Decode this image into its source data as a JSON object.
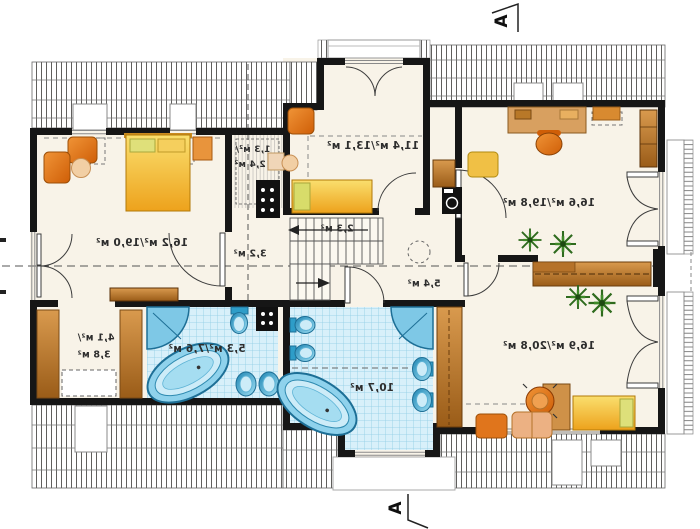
{
  "plan": {
    "title": "attic-floor-plan",
    "labels": {
      "room_top_center": "11,4 м²/13,1 м²",
      "bedroom_left": "16,2 м²/19,0 м²",
      "room_top_right": "16,6 м²/19,8 м²",
      "room_bottom_right": "16,9 м²/20,8 м²",
      "bathroom_small": "5,3 м²/7,6 м²",
      "bathroom_large": "10,7 м²",
      "stairs": "2,3 м²",
      "hall_west": "3,2 м²",
      "hall_east": "5,4 м²",
      "closet_line1": "1,3 м²/",
      "closet_line2": "2,4 м²",
      "wardrobe_line1": "4,1 м²/",
      "wardrobe_line2": "3,8 м²"
    },
    "section_markers": {
      "top": "A",
      "bottom": "A"
    },
    "colors": {
      "wall": "#161616",
      "floor": "#f8f3e8",
      "tile_blue": "#d8f0fa",
      "fixture_blue": "#2e9dc8",
      "furniture_orange": "#e87b1c",
      "bed_yellow": "#f2c12e",
      "wood_brown": "#c07b35",
      "plant_green": "#2f6b1e"
    }
  }
}
